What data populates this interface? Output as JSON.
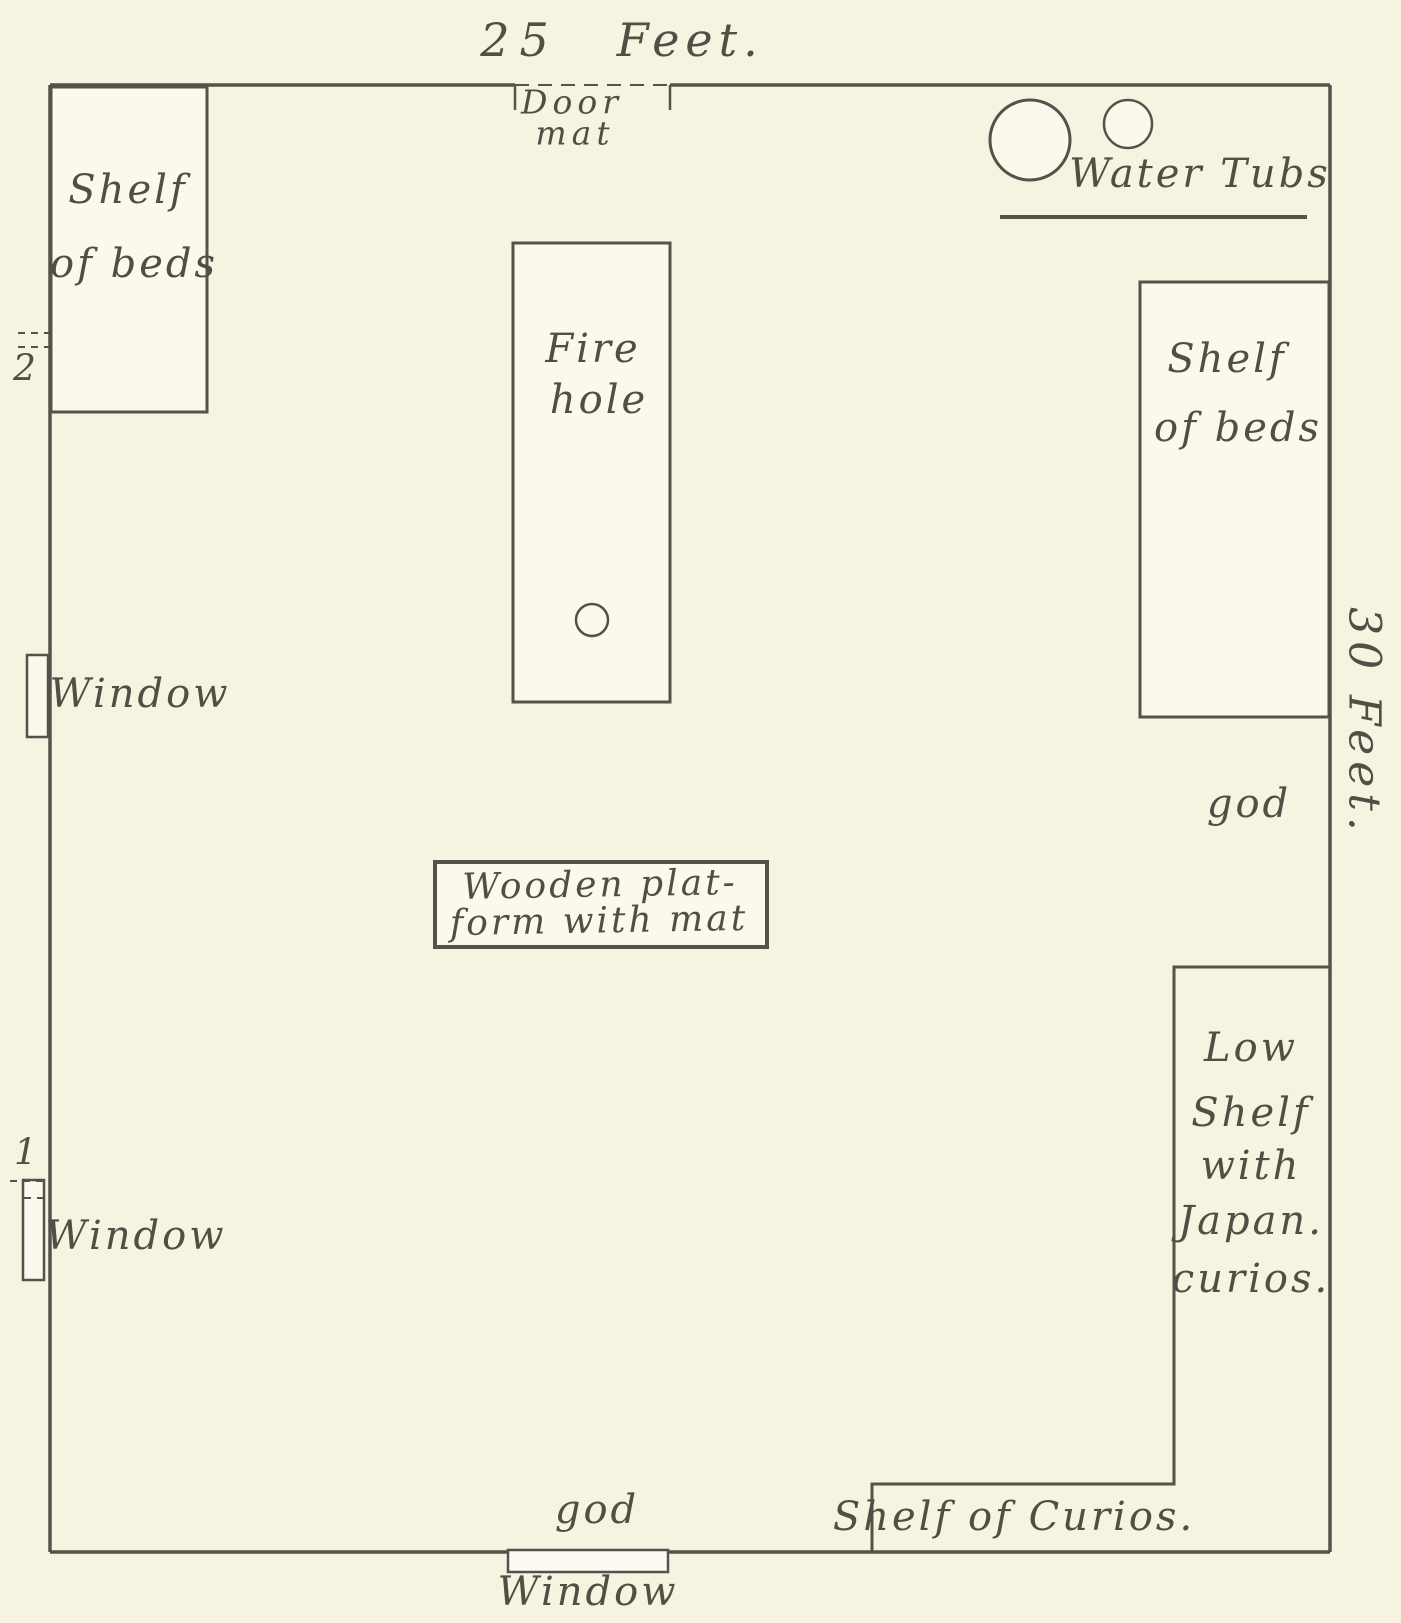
{
  "dimensions": {
    "top": {
      "number": "25",
      "unit": "Feet."
    },
    "right": "30 Feet."
  },
  "door": {
    "line1": "Door",
    "line2": "mat"
  },
  "water_tubs": {
    "label": "Water Tubs"
  },
  "shelf_of_beds_left": {
    "line1": "Shelf",
    "line2": "of beds"
  },
  "shelf_of_beds_right": {
    "line1": "Shelf",
    "line2": "of beds"
  },
  "fire_hole": {
    "line1": "Fire",
    "line2": "hole"
  },
  "windows": {
    "upper_left": "Window",
    "lower_left": "Window",
    "bottom": "Window"
  },
  "god_shelf_right": "god",
  "god_shelf_bottom": "god",
  "wooden_platform": {
    "line1": "Wooden plat-",
    "line2": "form with mat"
  },
  "low_shelf": {
    "line1": "Low",
    "line2": "Shelf",
    "line3": "with",
    "line4": "Japan.",
    "line5": "curios."
  },
  "shelf_of_curios": "Shelf of Curios.",
  "wall_marks": {
    "upper": "2",
    "lower": "1"
  },
  "colors": {
    "paper": "#f7f3e1",
    "ink": "#52534a",
    "furniture_fill": "#fcf9ec"
  }
}
